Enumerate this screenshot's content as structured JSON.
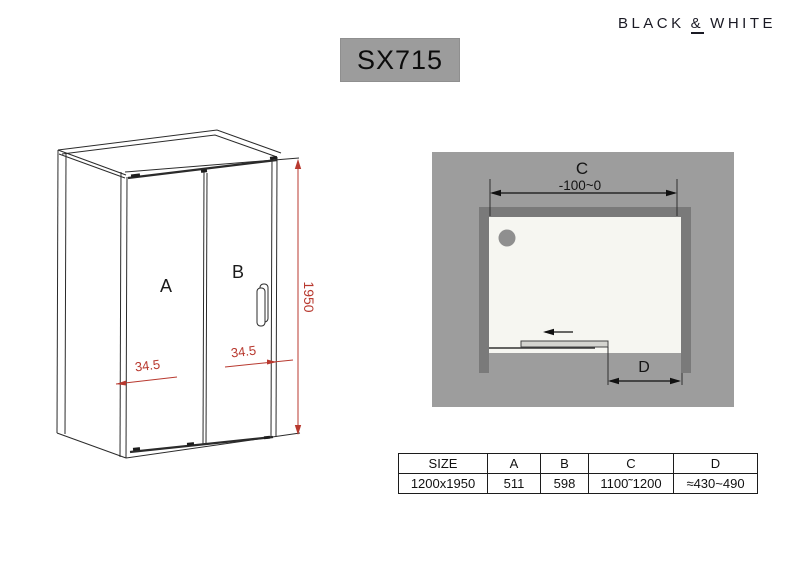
{
  "brand": {
    "word1": "BLACK",
    "amp": "&",
    "word2": "WHITE"
  },
  "model_label": "SX715",
  "front_drawing": {
    "panel_a_label": "A",
    "panel_b_label": "B",
    "height_dim": "1950",
    "left_offset_dim": "34.5",
    "right_offset_dim": "34.5"
  },
  "top_view": {
    "c_label": "C",
    "c_range": "-100~0",
    "d_label": "D"
  },
  "spec_table": {
    "headers": [
      "SIZE",
      "A",
      "B",
      "C",
      "D"
    ],
    "values": [
      "1200x1950",
      "511",
      "598",
      "1100˜1200",
      "≈430~490"
    ]
  },
  "colors": {
    "dimension_red": "#b8392f",
    "badge_gray": "#9c9c9c",
    "floor_gray": "#9d9d9d",
    "wall_gray": "#7a7a7a",
    "tray_white": "#f6f6f1",
    "line_black": "#2b2b2b"
  }
}
